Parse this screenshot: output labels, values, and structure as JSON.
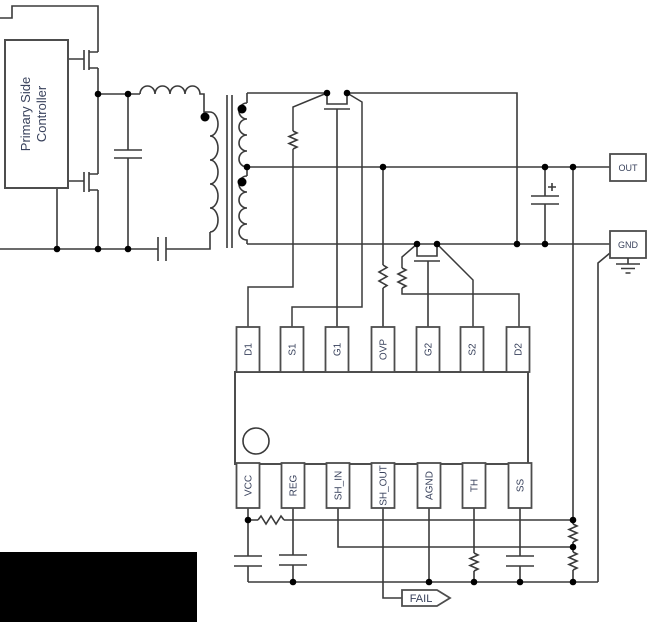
{
  "primary_controller": {
    "label_line1": "Primary Side",
    "label_line2": "Controller"
  },
  "ic": {
    "top_pins": [
      "D1",
      "S1",
      "G1",
      "OVP",
      "G2",
      "S2",
      "D2"
    ],
    "bottom_pins": [
      "VCC",
      "REG",
      "SH_IN",
      "SH_OUT",
      "AGND",
      "TH",
      "SS"
    ]
  },
  "terminals": {
    "out": "OUT",
    "gnd": "GND"
  },
  "flags": {
    "fail": "FAIL"
  },
  "colors": {
    "wire": "#3a3a3a",
    "component_border": "#4d4d4d",
    "label_text": "#39425c",
    "junction_dot": "#000000",
    "redaction_block": "#000000"
  }
}
